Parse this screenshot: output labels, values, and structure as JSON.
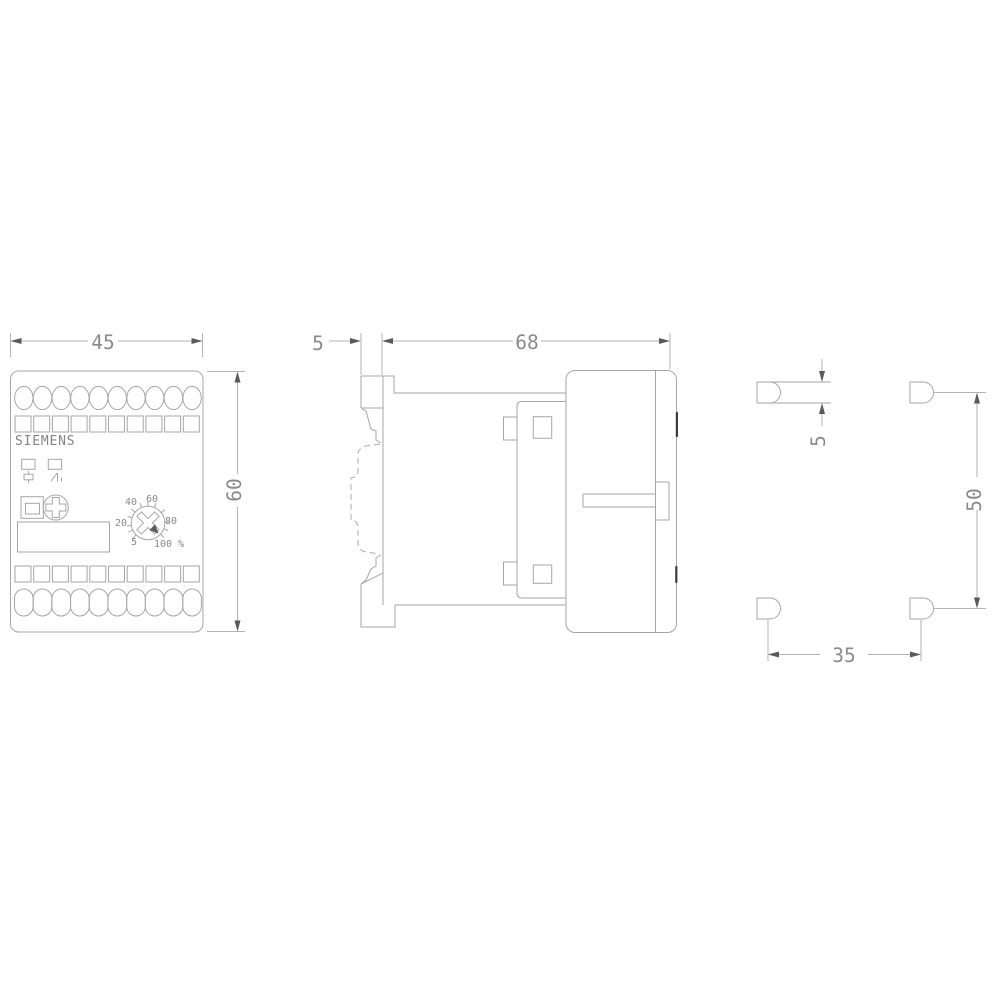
{
  "drawing": {
    "brand_label": "SIEMENS",
    "front_view": {
      "width_dim": "45",
      "height_dim": "60",
      "dial_labels": {
        "p5": "5",
        "p20": "20",
        "p40": "40",
        "p60": "60",
        "p80": "80",
        "p100": "100 %"
      }
    },
    "side_view": {
      "rail_depth_dim": "5",
      "depth_dim": "68"
    },
    "drilling_pattern": {
      "slot_width_dim": "5",
      "vertical_pitch_dim": "50",
      "horizontal_pitch_dim": "35"
    }
  },
  "colors": {
    "background": "#ffffff",
    "line": "#a6a6a6",
    "text": "#8a8a8a",
    "dark_accent": "#3c3c3c"
  }
}
